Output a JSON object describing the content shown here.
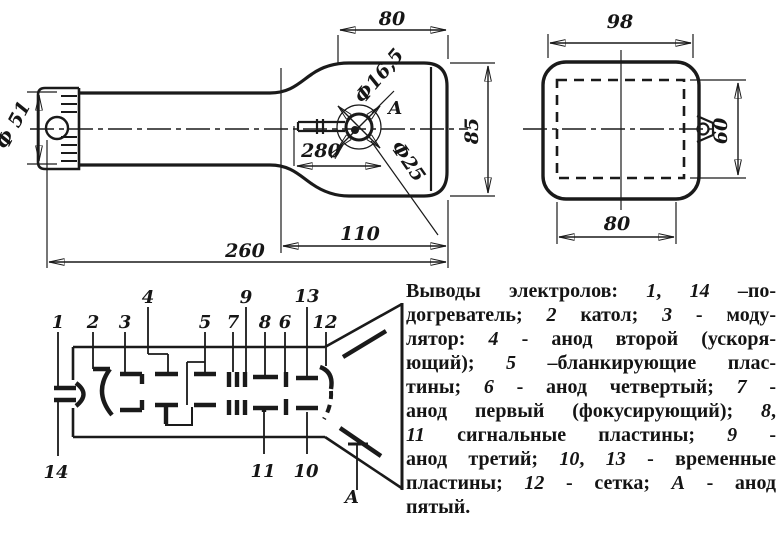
{
  "side_view": {
    "neck_dia": "Ф 51",
    "face_width": "80",
    "anode_hole_dia": "Ф16,5",
    "anode_view_label": "А",
    "anode_circle_dia": "Ф25",
    "ref_length": "280",
    "face_height": "85",
    "flare_length": "110",
    "total_length": "260"
  },
  "front_view": {
    "outer_width": "98",
    "screen_height": "60",
    "screen_width": "80"
  },
  "diagram": {
    "pins": {
      "p1": "1",
      "p2": "2",
      "p3": "3",
      "p4": "4",
      "p5": "5",
      "p6": "6",
      "p7": "7",
      "p8": "8",
      "p9": "9",
      "p10": "10",
      "p11": "11",
      "p12": "12",
      "p13": "13",
      "p14": "14",
      "pa": "А"
    }
  },
  "description": {
    "lines": [
      "Выводы электролов: 1, 14 –по-",
      "догреватель; 2 катол; 3 - моду-",
      "лятор: 4 - анод второй (ускоря-",
      "ющий); 5 –бланкирующие плас-",
      "тины; 6 - анод четвертый; 7 -",
      "анод первый (фокусирующий); 8,",
      "11 сигнальные пластины; 9 -",
      "анод третий; 10, 13 - временные",
      "пластины; 12 - сетка; А - анод",
      "пятый."
    ]
  }
}
